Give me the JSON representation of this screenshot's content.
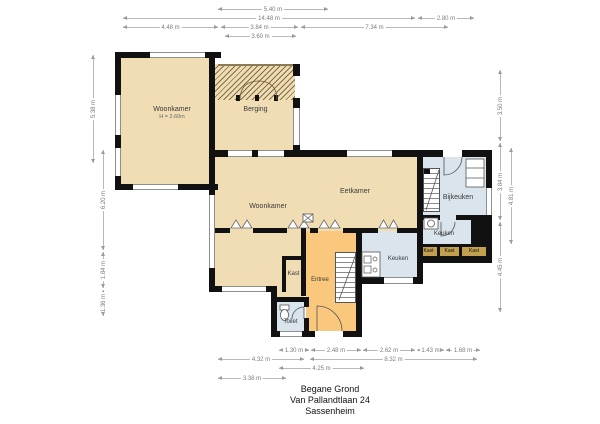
{
  "colors": {
    "room_tan": "#f0ddb4",
    "hall_orange": "#f9c87c",
    "wet_blue": "#d9e4ec",
    "closet_khaki": "#c2a04f",
    "wall": "#111111"
  },
  "rooms": {
    "woonkamer_1": {
      "label": "Woonkamer",
      "height_note": "H = 2.60m"
    },
    "berging": {
      "label": "Berging"
    },
    "woonkamer_2": {
      "label": "Woonkamer"
    },
    "eetkamer": {
      "label": "Eetkamer"
    },
    "bijkeuken": {
      "label": "Bijkeuken"
    },
    "keuken_achter": {
      "label": "Keuken"
    },
    "keuken": {
      "label": "Keuken"
    },
    "entree": {
      "label": "Entree"
    },
    "kast_hal": {
      "label": "Kast"
    },
    "kast_1": {
      "label": "Kast"
    },
    "kast_2": {
      "label": "Kast"
    },
    "kast_3": {
      "label": "Kast"
    },
    "toilet": {
      "label": "Toilet"
    }
  },
  "dimensions": {
    "top": {
      "d540": "5.40 m",
      "d1448": "14.48 m",
      "d280": "2.80 m",
      "d448": "4.48 m",
      "d384": "3.84 m",
      "d734": "7.34 m",
      "d360": "3.60 m"
    },
    "bottom": {
      "d130": "1.30 m",
      "d248": "2.48 m",
      "d262": "2.62 m",
      "d143": "1.43 m",
      "d168": "1.68 m",
      "d432": "4.32 m",
      "d832": "8.32 m",
      "d425": "4.25 m",
      "d338": "3.38 m"
    },
    "left": {
      "d538": "5.38 m",
      "d620": "6.20 m",
      "d184": "1.84 m",
      "d136": "1.36 m"
    },
    "right": {
      "d350": "3.50 m",
      "d384": "3.84 m",
      "d445": "4.45 m",
      "d481": "4.81 m"
    }
  },
  "title_block": {
    "floor": "Begane Grond",
    "address": "Van Pallandtlaan 24",
    "city": "Sassenheim"
  }
}
